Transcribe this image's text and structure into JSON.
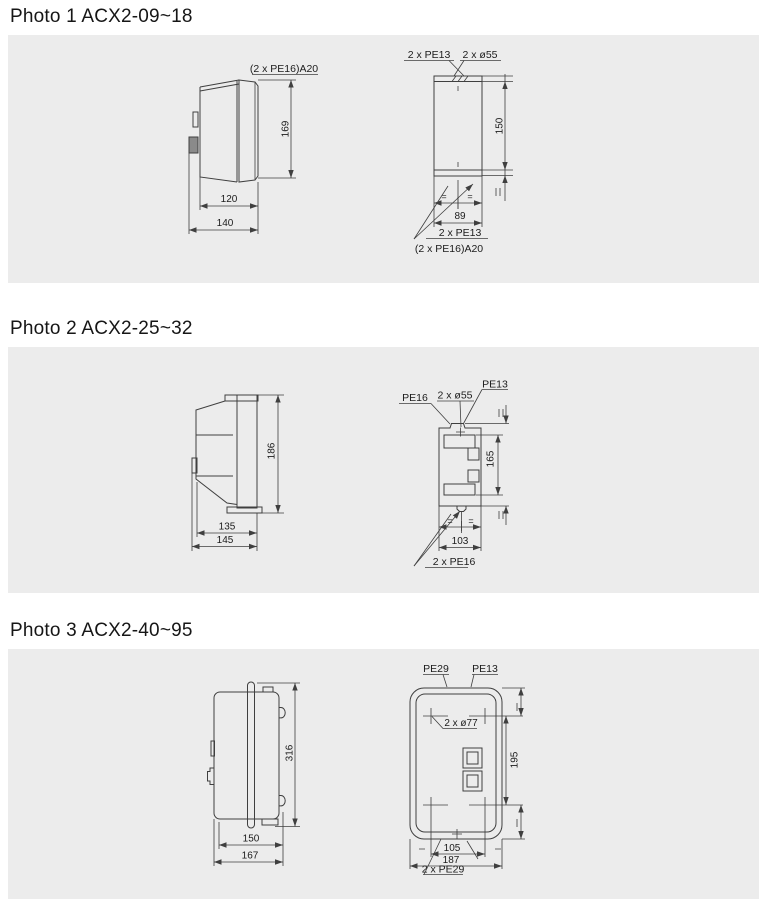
{
  "page": {
    "background": "#ffffff",
    "panel_background": "#ececec",
    "line_color": "#3f3f3f",
    "text_color": "#1c1c1c"
  },
  "sections": [
    {
      "title": "Photo 1 ACX2-09~18",
      "side_view": {
        "top_label": "(2 x PE16)A20",
        "height": "169",
        "width_inner": "120",
        "width_outer": "140"
      },
      "front_view": {
        "top_left_label": "2 x PE13",
        "top_right_label": "2 x ø55",
        "height": "150",
        "width": "89",
        "equal_mark": "=",
        "bottom_label_1": "2 x PE13",
        "bottom_label_2": "(2 x PE16)A20"
      }
    },
    {
      "title": "Photo 2 ACX2-25~32",
      "side_view": {
        "height": "186",
        "width_inner": "135",
        "width_outer": "145"
      },
      "front_view": {
        "top_left_label": "PE16",
        "top_mid_label": "2 x ø55",
        "top_right_label": "PE13",
        "height": "165",
        "width": "103",
        "equal_mark": "=",
        "bottom_label": "2 x PE16"
      }
    },
    {
      "title": "Photo 3 ACX2-40~95",
      "side_view": {
        "height": "316",
        "width_inner": "150",
        "width_outer": "167"
      },
      "front_view": {
        "top_left_label": "PE29",
        "top_right_label": "PE13",
        "holes_label": "2 x ø77",
        "height": "195",
        "width_inner": "105",
        "width_outer": "187",
        "bottom_label": "2 x PE29"
      }
    }
  ]
}
